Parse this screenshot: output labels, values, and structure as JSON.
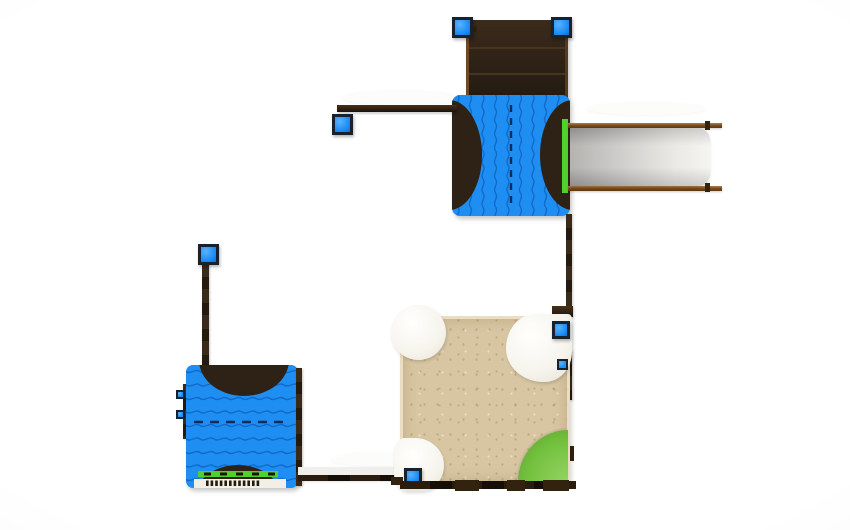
{
  "scene": {
    "type": "3d-render-top-view",
    "subject": "playground set plan view: roof deck, wave climber panels, slide, sandbox"
  },
  "colors": {
    "background": "#ffffff",
    "vignette": "#ececec",
    "panelBlue": "#1e8ef2",
    "waveLine": "#0d5cb8",
    "dashLine": "#0b2d56",
    "darkWood": "#2e2115",
    "roofDark": "#302418",
    "woodTrim": "#7c4e22",
    "woodLight": "#a87c42",
    "slideGray": "#a6a5a2",
    "slideGrayLight": "#f3f2ef",
    "sand": "#d8c6a3",
    "sandEdge": "#e9ddc2",
    "green": "#74c13f",
    "greenBright": "#4ed32c",
    "whitePlastic": "#f6f4ec",
    "capBlue": "#1d8df5",
    "capBlueLight": "#5ab2ff",
    "capBorder": "#18222f"
  },
  "components": {
    "roof": "roof-deck-panel",
    "climberTop": "wave-climber-panel-vertical-waves",
    "climberLower": "wave-climber-panel-horizontal-waves",
    "slide": "straight-slide",
    "sandbox": "sand-play-area",
    "grass": "grass-quarter-circle",
    "posts": "blue-capped-posts"
  }
}
